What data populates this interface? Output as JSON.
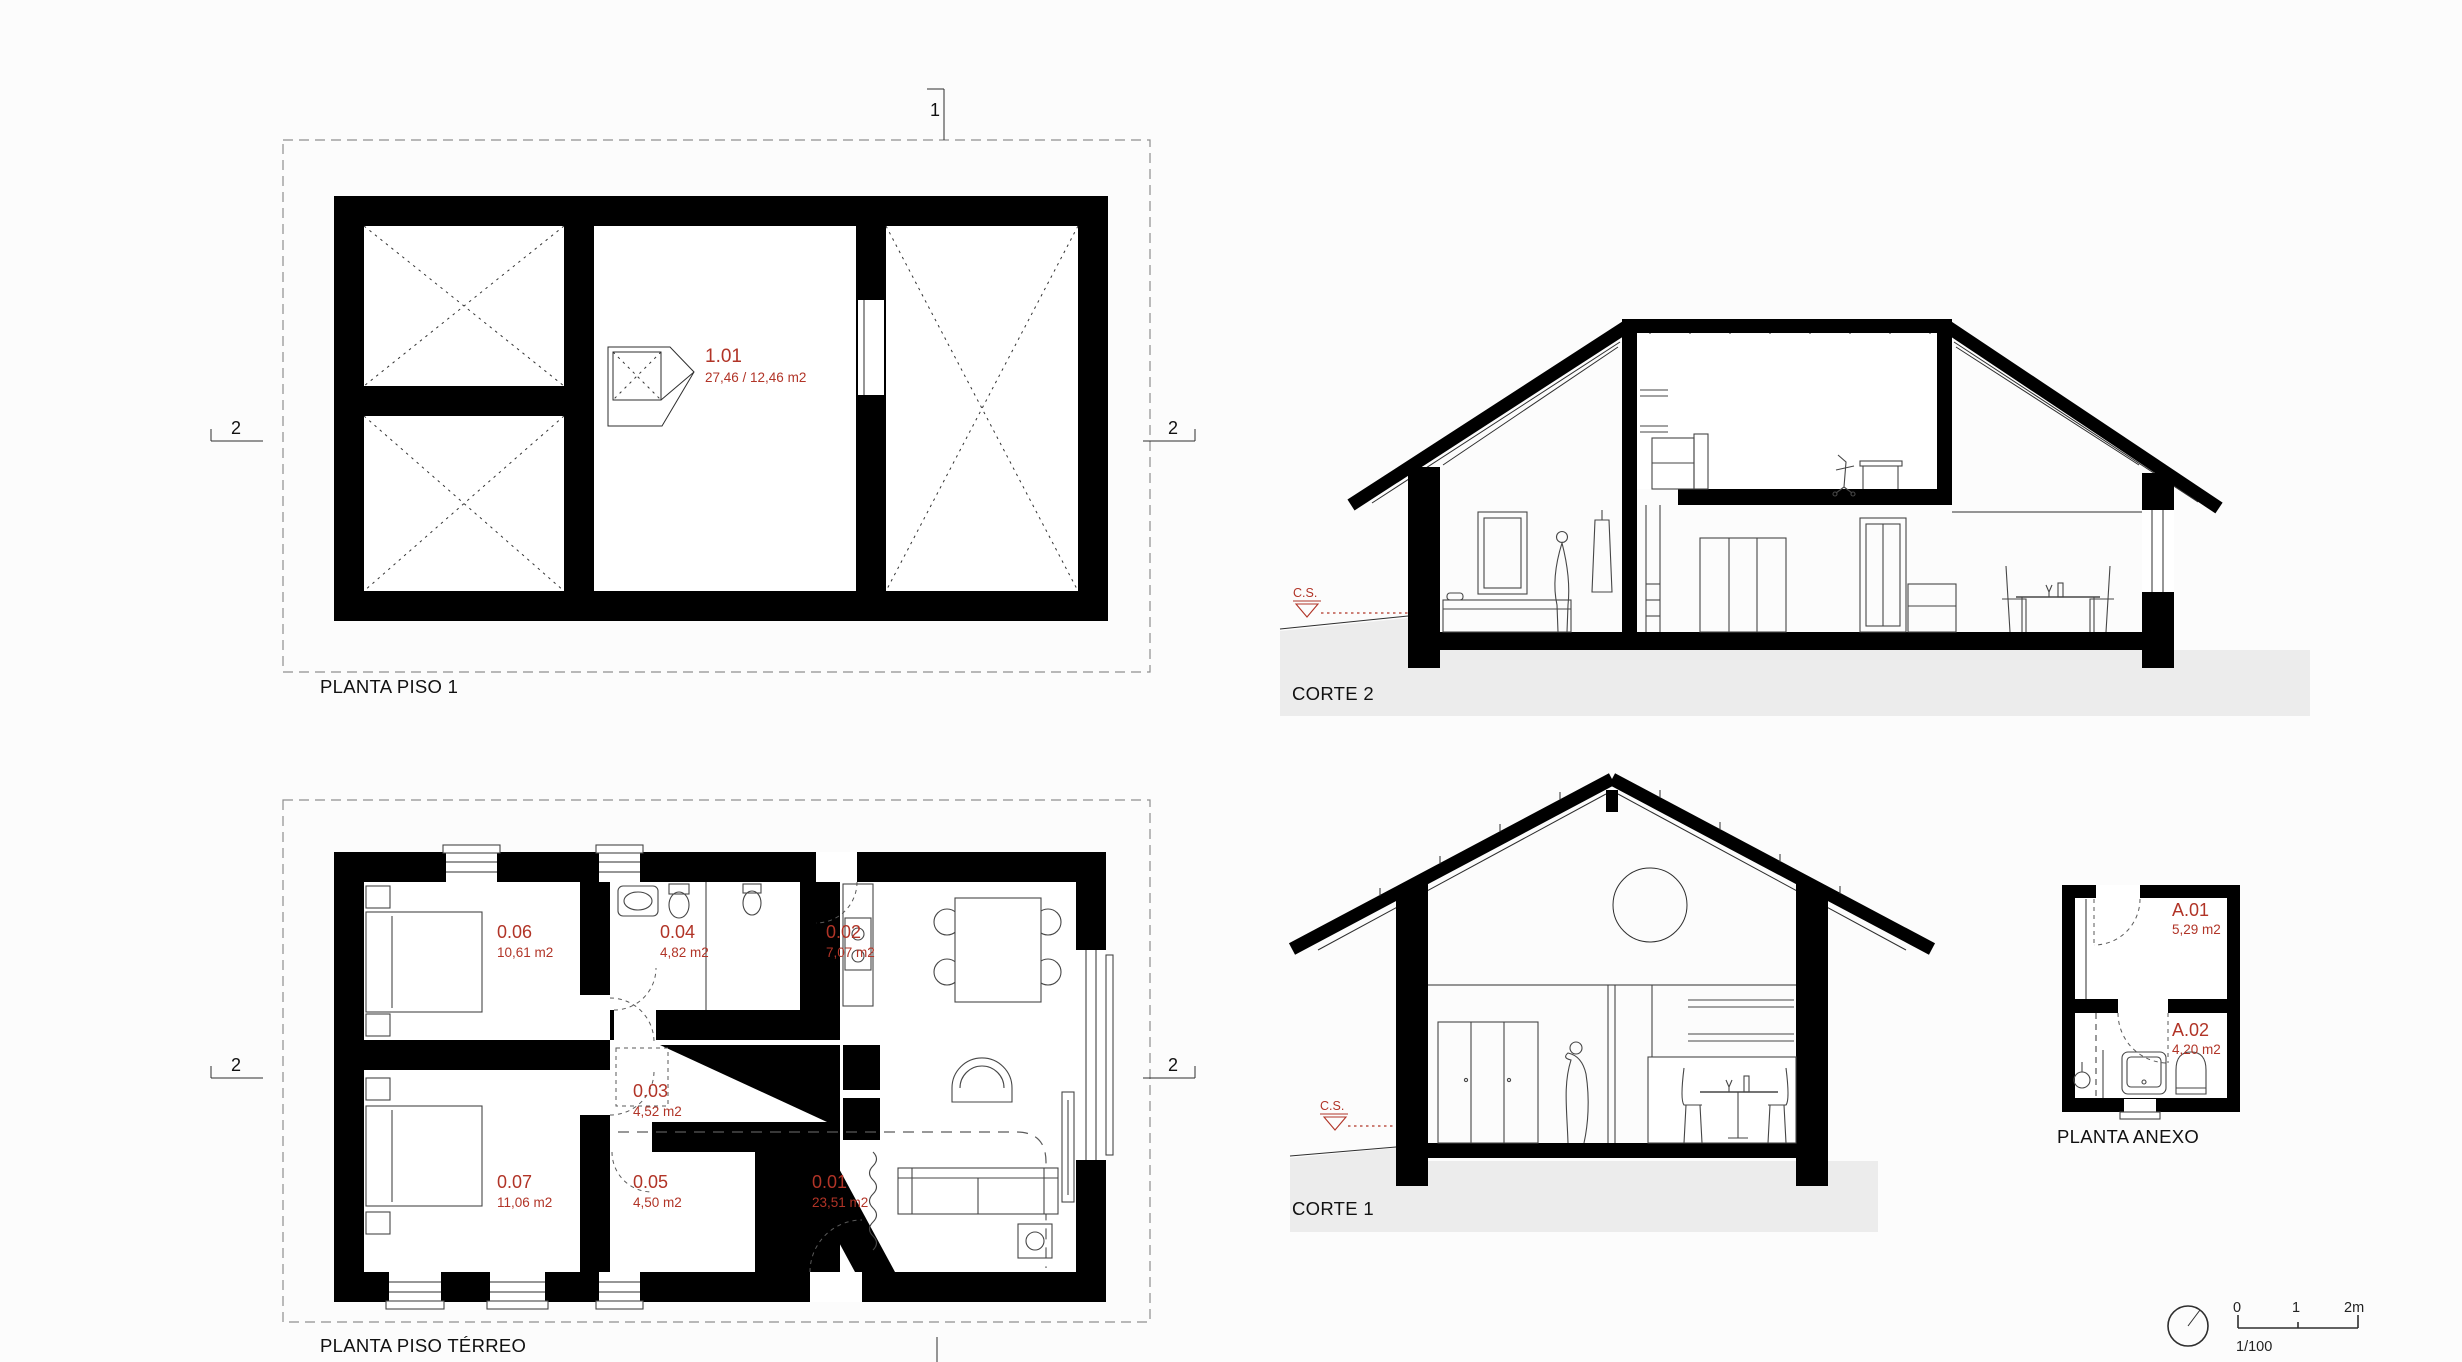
{
  "colors": {
    "accent_red": "#b13427",
    "ink": "#111111",
    "ground_gray": "#ececec"
  },
  "plans": {
    "piso1": {
      "title": "PLANTA PISO 1",
      "room": {
        "id": "1.01",
        "area": "27,46 / 12,46 m2"
      },
      "markers": {
        "top": "1",
        "left": "2",
        "right": "2"
      }
    },
    "terreo": {
      "title": "PLANTA PISO TÉRREO",
      "markers": {
        "left": "2",
        "right": "2"
      },
      "rooms": [
        {
          "id": "0.06",
          "area": "10,61 m2"
        },
        {
          "id": "0.04",
          "area": "4,82 m2"
        },
        {
          "id": "0.02",
          "area": "7,07 m2"
        },
        {
          "id": "0.03",
          "area": "4,52 m2"
        },
        {
          "id": "0.07",
          "area": "11,06 m2"
        },
        {
          "id": "0.05",
          "area": "4,50 m2"
        },
        {
          "id": "0.01",
          "area": "23,51 m2"
        }
      ]
    },
    "anexo": {
      "title": "PLANTA ANEXO",
      "rooms": [
        {
          "id": "A.01",
          "area": "5,29 m2"
        },
        {
          "id": "A.02",
          "area": "4,20 m2"
        }
      ]
    }
  },
  "sections": {
    "corte2": {
      "title": "CORTE 2",
      "level": "C.S."
    },
    "corte1": {
      "title": "CORTE 1",
      "level": "C.S."
    }
  },
  "sheet": {
    "scale_ratio": "1/100",
    "scale_ticks": {
      "t0": "0",
      "t1": "1",
      "t2": "2m"
    }
  }
}
